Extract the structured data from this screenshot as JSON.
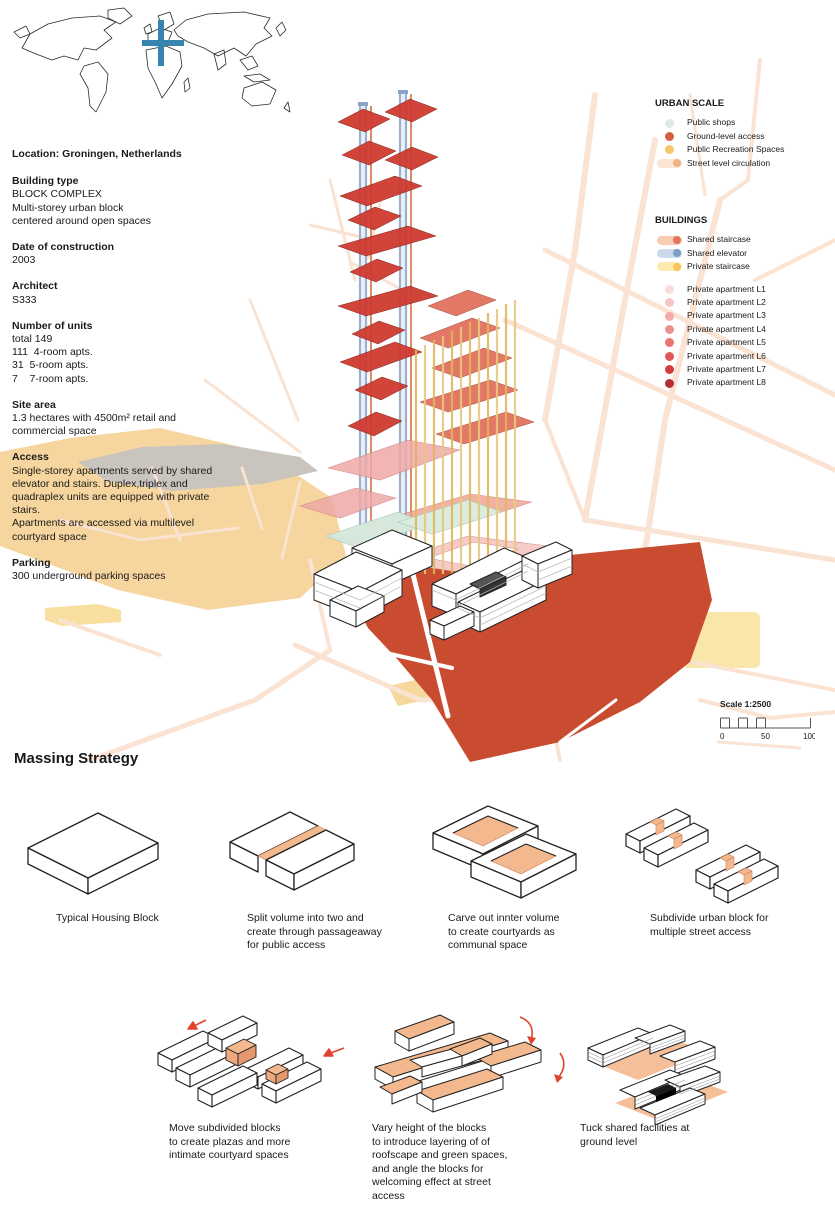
{
  "info_panel": {
    "location": "Location: Groningen, Netherlands",
    "sections": [
      {
        "heading": "Building type",
        "body": "BLOCK COMPLEX\nMulti-storey urban block\ncentered around open spaces"
      },
      {
        "heading": "Date of construction",
        "body": "2003"
      },
      {
        "heading": "Architect",
        "body": "S333"
      },
      {
        "heading": "Number of units",
        "body": "total 149\n111  4-room apts.\n31  5-room apts.\n7    7-room apts."
      },
      {
        "heading": "Site area",
        "body": "1.3 hectares with 4500m² retail and\ncommercial space"
      },
      {
        "heading": "Access",
        "body": "Single-storey apartments served by shared\nelevator and stairs. Duplex,triplex and\nquadraplex units are equipped with private\nstairs.\nApartments are accessed via multilevel\ncourtyard space"
      },
      {
        "heading": "Parking",
        "body": "300 underground parking spaces"
      }
    ]
  },
  "legends": {
    "urban_scale": {
      "title": "URBAN SCALE",
      "items": [
        {
          "label": "Public shops",
          "color": "#dce9e5"
        },
        {
          "label": "Ground-level access",
          "color": "#d95f43"
        },
        {
          "label": "Public Recreation Spaces",
          "color": "#f6c76b"
        },
        {
          "label": "Street level circulation",
          "color": "#fce5d3",
          "dot": "#f2b185"
        }
      ]
    },
    "buildings": {
      "title": "BUILDINGS",
      "pills": [
        {
          "label": "Shared staircase",
          "color": "#f9ccb2",
          "dot": "#e2765a"
        },
        {
          "label": "Shared elevator",
          "color": "#ccd9e9",
          "dot": "#7f9dc5"
        },
        {
          "label": "Private staircase",
          "color": "#fdeab1",
          "dot": "#f6c65d"
        }
      ],
      "apartments": [
        {
          "label": "Private apartment L1",
          "color": "#fadcda"
        },
        {
          "label": "Private apartment L2",
          "color": "#f7c6c4"
        },
        {
          "label": "Private apartment L3",
          "color": "#f3abaa"
        },
        {
          "label": "Private apartment L4",
          "color": "#ee908e"
        },
        {
          "label": "Private apartment L5",
          "color": "#e97673"
        },
        {
          "label": "Private apartment L6",
          "color": "#e15755"
        },
        {
          "label": "Private apartment L7",
          "color": "#d23c3e"
        },
        {
          "label": "Private apartment L8",
          "color": "#b13034"
        }
      ]
    }
  },
  "scale_bar": {
    "label": "Scale 1:2500",
    "ticks": [
      "0",
      "50",
      "100"
    ]
  },
  "massing": {
    "title": "Massing Strategy",
    "steps": [
      {
        "caption": "Typical Housing Block"
      },
      {
        "caption": "Split volume into two and\ncreate through passageaway\nfor public access"
      },
      {
        "caption": "Carve out innter volume\nto create courtyards as\ncommunal space"
      },
      {
        "caption": "Subdivide urban block for\nmultiple street access"
      },
      {
        "caption": "Move subdivided blocks\nto create plazas and more\nintimate courtyard spaces"
      },
      {
        "caption": "Vary height of the blocks\nto introduce layering of of\nroofscape and green spaces,\nand angle the blocks for\nwelcoming effect at street\naccess"
      },
      {
        "caption": "Tuck shared facilities at\nground level"
      }
    ]
  },
  "palette": {
    "street": "#fae3d2",
    "park": "#f6d69e",
    "water_gray": "#c9c4be",
    "site_red": "#c94c31",
    "plate_red": "#cf3a30",
    "plate_salmon": "#e06a56",
    "plate_pink": "#efa9a7",
    "plate_teal": "#d6e8dc",
    "shaft_blue": "#9bb0cf",
    "shaft_orange": "#e08a60",
    "shaft_yellow": "#dfb65e",
    "marker_blue": "#3685ae",
    "massing_orange": "#f3b88e",
    "arrow_red": "#e0442e"
  }
}
